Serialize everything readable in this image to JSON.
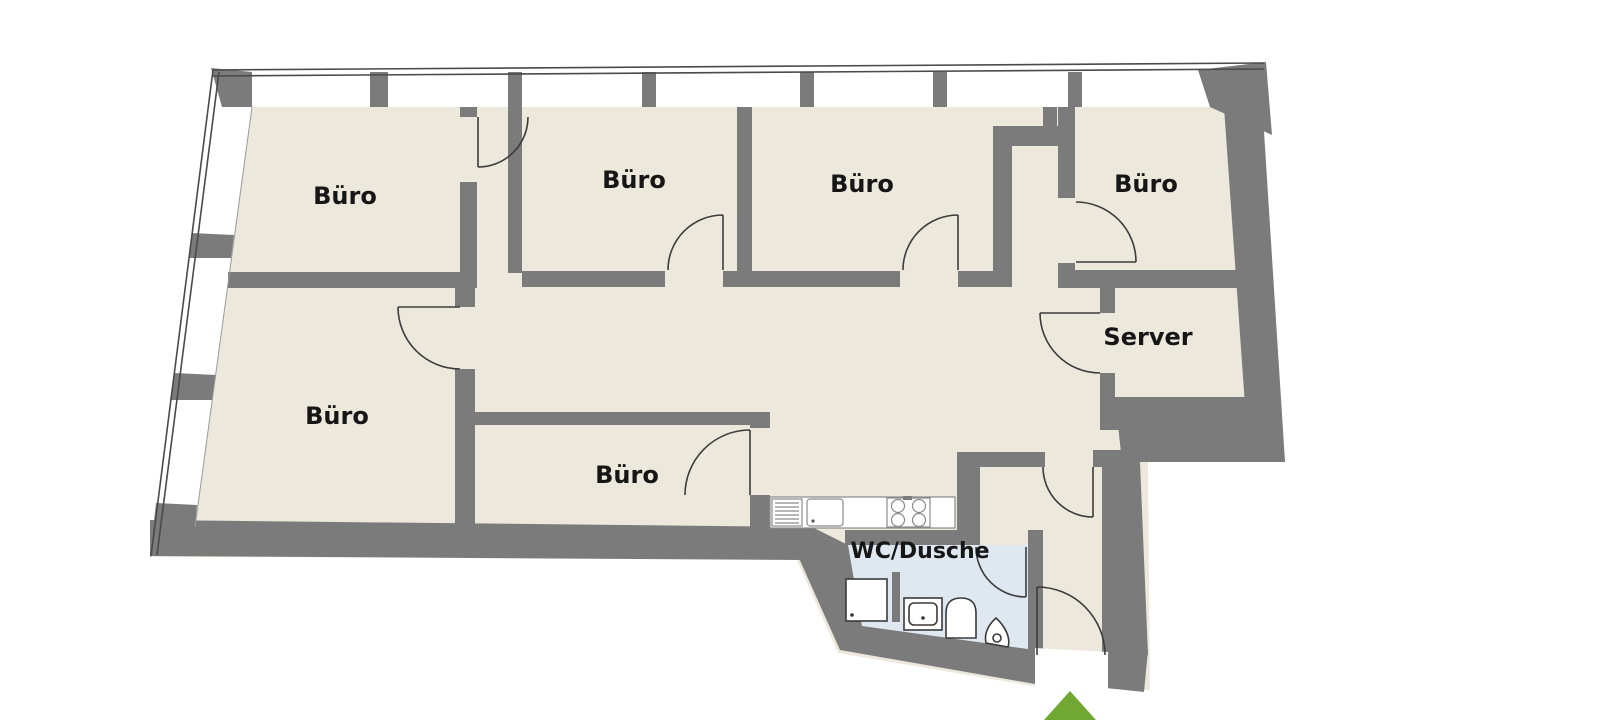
{
  "plan_type": "office-floor-plan",
  "rooms": [
    {
      "id": "buero-top-left",
      "label": "Büro"
    },
    {
      "id": "buero-top-mid-left",
      "label": "Büro"
    },
    {
      "id": "buero-top-mid-right",
      "label": "Büro"
    },
    {
      "id": "buero-top-right",
      "label": "Büro"
    },
    {
      "id": "server",
      "label": "Server"
    },
    {
      "id": "buero-left",
      "label": "Büro"
    },
    {
      "id": "buero-bottom-center",
      "label": "Büro"
    },
    {
      "id": "wc-dusche",
      "label": "WC/Dusche"
    }
  ],
  "fixtures": [
    {
      "id": "kitchen-counter"
    },
    {
      "id": "dishwasher"
    },
    {
      "id": "kitchen-sink"
    },
    {
      "id": "stove-4-burners"
    },
    {
      "id": "shower"
    },
    {
      "id": "washbasin"
    },
    {
      "id": "toilet"
    },
    {
      "id": "urinal"
    }
  ],
  "entrance": {
    "marker": "arrow-up",
    "color": "#71a733"
  },
  "colors": {
    "wall": "#7b7b7b",
    "room_fill": "#ece8dc",
    "wet_room_fill": "#dfe8f1",
    "outline": "#4a4a4a",
    "background": "#ffffff",
    "label_text": "#161616"
  }
}
